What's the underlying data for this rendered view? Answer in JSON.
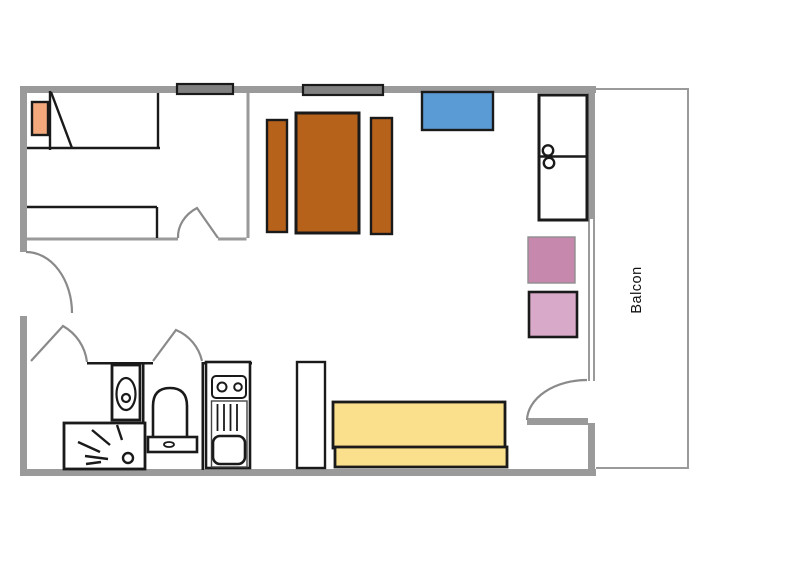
{
  "labels": {
    "balcony": "Balcon"
  },
  "colors": {
    "background": "#ffffff",
    "exterior_wall": "#9a9a9a",
    "partition_wall": "#9a9a9a",
    "balcony_outline": "#9a9a9a",
    "ink": "#1a1a1a",
    "door_arc": "#8a8a8a",
    "window_glass": "#808080",
    "wood_furniture": "#b7621b",
    "pillow": "#f4a97c",
    "blue_cabinet": "#5b9bd5",
    "pink_dark_stool": "#c688ac",
    "pink_light_stool": "#d9a9c9",
    "sofa_yellow": "#fae08c",
    "fixture_white": "#ffffff",
    "label_text": "#111111"
  }
}
